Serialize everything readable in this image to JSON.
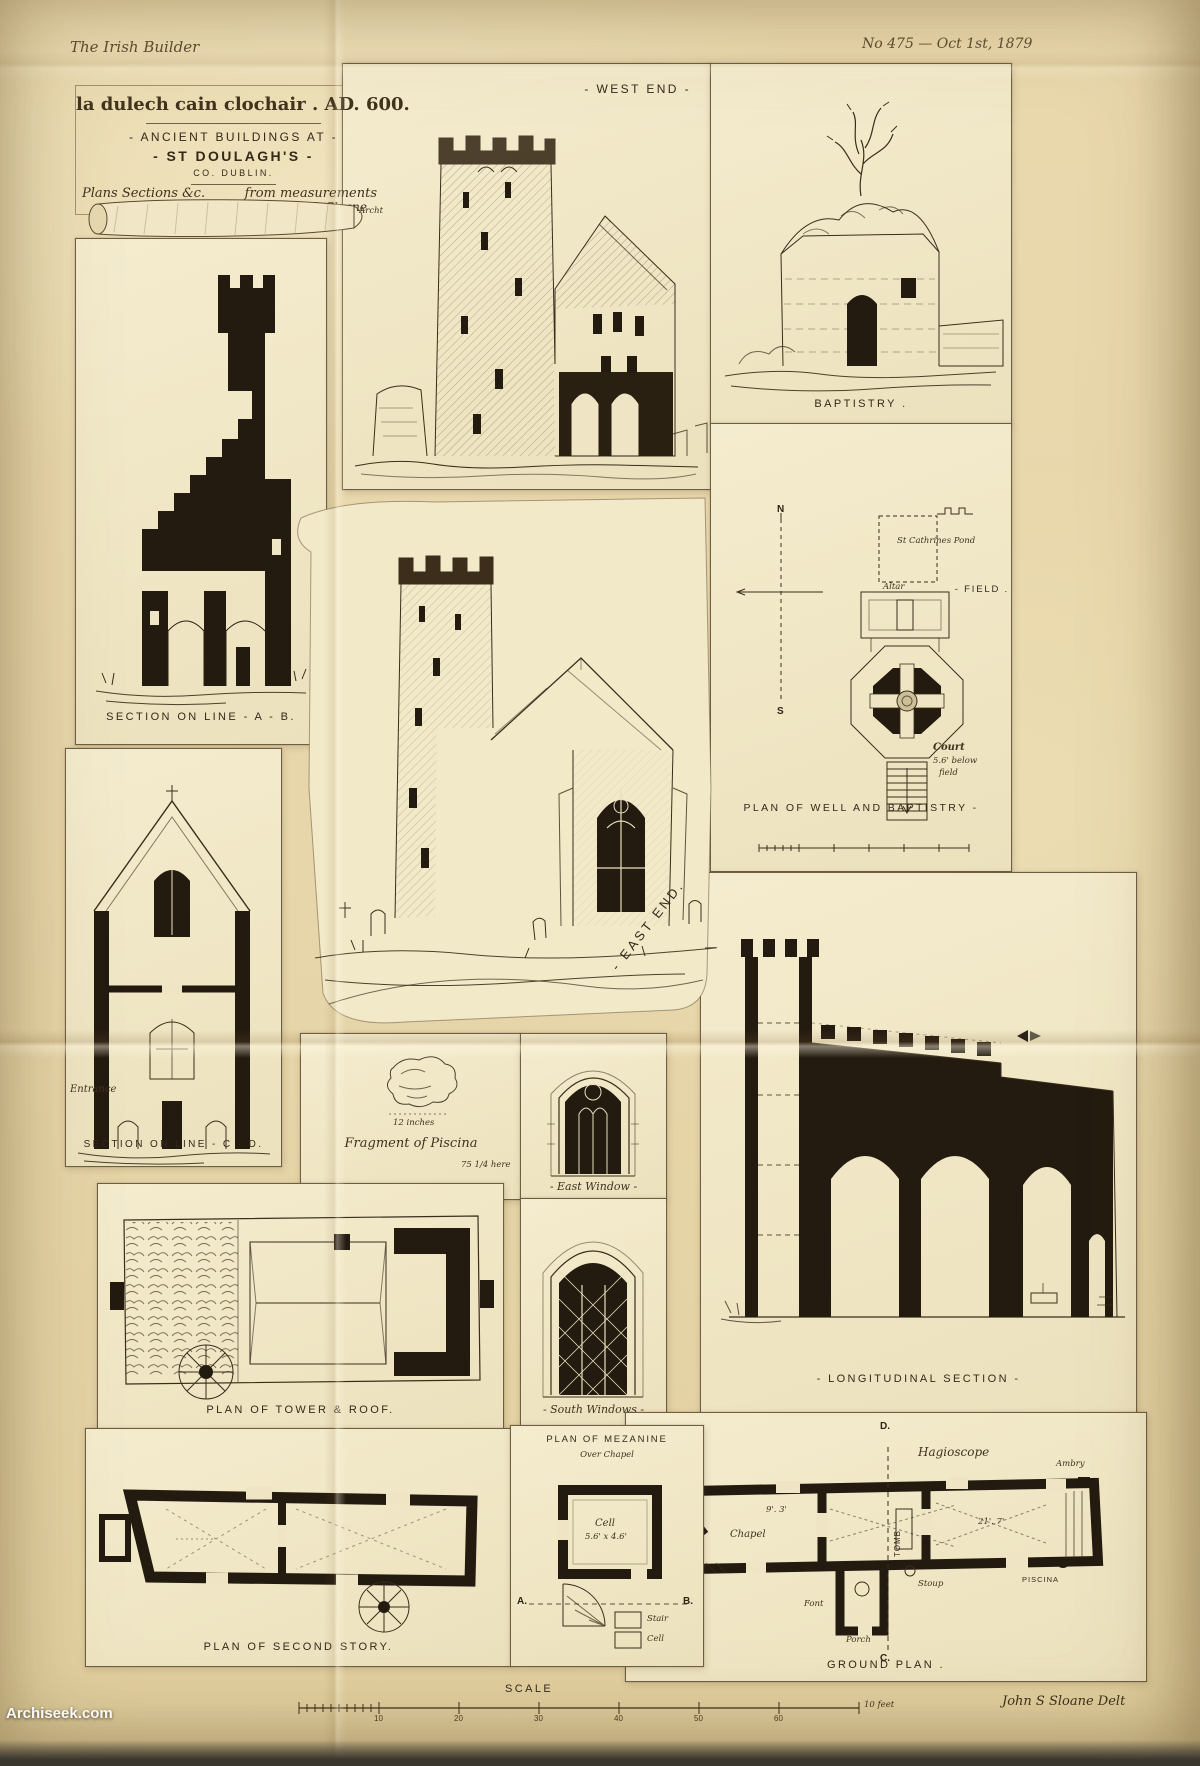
{
  "header": {
    "journal": "The Irish Builder",
    "issue": "No 475 — Oct 1st, 1879"
  },
  "title_block": {
    "gaelic": "la dulech cain clochair . AD. 600.",
    "line1": "- ANCIENT BUILDINGS AT -",
    "line2": "- ST DOULAGH'S -",
    "line3": "CO. DUBLIN.",
    "note1": "Plans Sections &c.",
    "note2": "from measurements",
    "note3": "by John S. Sloane",
    "note4": "Archt"
  },
  "west_end": {
    "caption": "- WEST END -"
  },
  "baptistry": {
    "caption": "BAPTISTRY ."
  },
  "well_plan": {
    "caption": "PLAN OF WELL AND BAPTISTRY -",
    "north": "N",
    "south": "S",
    "pond": "St Cathrines Pond",
    "field": "- FIELD .",
    "altar": "Altar",
    "court1": "Court",
    "court2": "5.6' below",
    "court3": "field"
  },
  "section_ab": {
    "caption": "SECTION ON LINE - A - B."
  },
  "section_cd": {
    "caption": "SECTION ON LINE - C - D.",
    "entrance": "Entrance"
  },
  "east_end": {
    "caption": "- EAST END."
  },
  "piscina": {
    "caption": "Fragment of Piscina",
    "note": "12 inches",
    "scale_note": "75 1/4 here"
  },
  "east_window": {
    "caption": "- East Window -"
  },
  "south_windows": {
    "caption": "- South Windows -"
  },
  "longitudinal": {
    "caption": "- LONGITUDINAL SECTION -"
  },
  "tower_roof": {
    "caption": "PLAN OF TOWER & ROOF."
  },
  "second_story": {
    "caption": "PLAN OF SECOND STORY."
  },
  "mezanine": {
    "caption": "PLAN OF MEZANINE",
    "sub": "Over Chapel",
    "cell_name": "Cell",
    "cell_dim": "5.6' x 4.6'",
    "marker_a": "A.",
    "marker_b": "B.",
    "stair": "Stair",
    "cell2": "Cell"
  },
  "ground_plan": {
    "caption": "GROUND PLAN .",
    "labels": {
      "hagioscope1": "Hagioscope",
      "hagioscope2": "Hagioscope",
      "chapel": "Chapel",
      "tomb": "TOMB",
      "porch": "Porch",
      "font": "Font",
      "stoup": "Stoup",
      "piscina": "PISCINA",
      "ambry": "Ambry",
      "marker_d": "D.",
      "marker_c": "C.",
      "dim1": "9'. 3'",
      "dim2": "21'. 7'"
    }
  },
  "footer": {
    "scale_label": "SCALE",
    "ticks": [
      "10",
      "20",
      "30",
      "40",
      "50",
      "60"
    ],
    "feet": "10 feet",
    "credit": "John S Sloane Delt"
  },
  "watermark": "Archiseek.com"
}
